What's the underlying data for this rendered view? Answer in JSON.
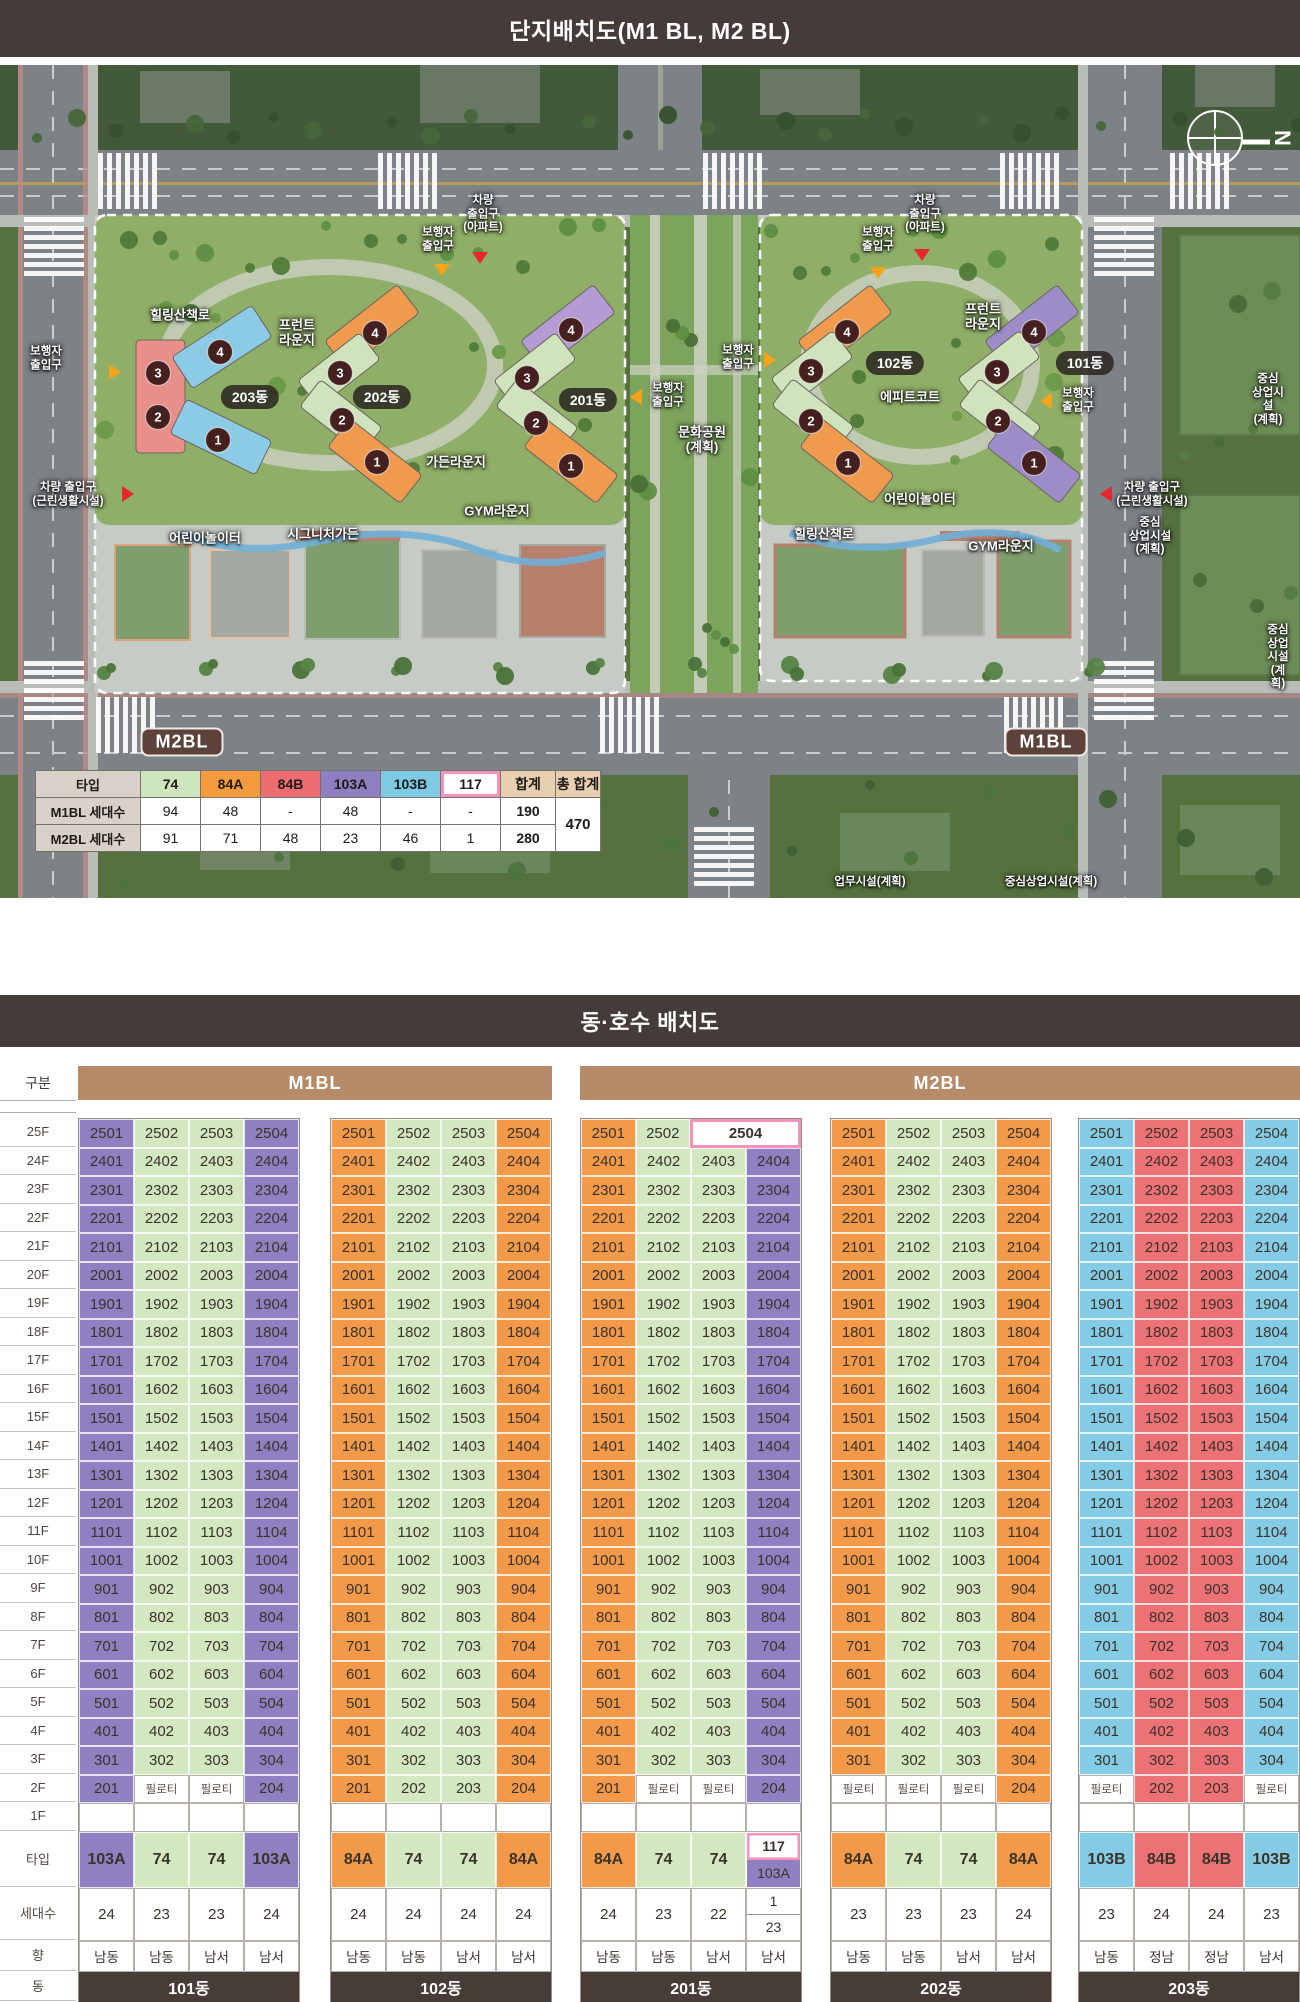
{
  "headers": {
    "site_plan": "단지배치도(M1 BL, M2 BL)",
    "unit_layout": "동·호수 배치도"
  },
  "site_plan": {
    "compass_label": "N",
    "table": {
      "header": [
        "타입",
        "74",
        "84A",
        "84B",
        "103A",
        "103B",
        "117",
        "합계",
        "총 합계"
      ],
      "rows": [
        {
          "label": "M1BL 세대수",
          "values": [
            "94",
            "48",
            "-",
            "48",
            "-",
            "-",
            "190"
          ]
        },
        {
          "label": "M2BL 세대수",
          "values": [
            "91",
            "71",
            "48",
            "23",
            "46",
            "1",
            "280"
          ]
        }
      ],
      "grand_total": "470"
    },
    "labels": [
      {
        "t": "힐링산책로",
        "x": 180,
        "y": 250
      },
      {
        "t": "프런트\n라운지",
        "x": 297,
        "y": 268
      },
      {
        "t": "가든라운지",
        "x": 456,
        "y": 397
      },
      {
        "t": "GYM라운지",
        "x": 497,
        "y": 446
      },
      {
        "t": "어린이놀이터",
        "x": 205,
        "y": 473
      },
      {
        "t": "시그니처가든",
        "x": 323,
        "y": 469
      },
      {
        "t": "문화공원\n(계획)",
        "x": 702,
        "y": 375
      },
      {
        "t": "에피트코트",
        "x": 910,
        "y": 332
      },
      {
        "t": "어린이놀이터",
        "x": 920,
        "y": 434
      },
      {
        "t": "힐링산책로",
        "x": 824,
        "y": 469
      },
      {
        "t": "GYM라운지",
        "x": 1001,
        "y": 481
      },
      {
        "t": "프런트\n라운지",
        "x": 983,
        "y": 252
      },
      {
        "t": "중심\n상업시설\n(계획)",
        "x": 1268,
        "y": 335,
        "small": 1
      },
      {
        "t": "중심\n상업시설\n(계획)",
        "x": 1150,
        "y": 472,
        "small": 1
      },
      {
        "t": "중심\n상업시설\n(계획)",
        "x": 1278,
        "y": 593,
        "small": 1
      },
      {
        "t": "업무시설(계획)",
        "x": 870,
        "y": 818,
        "small": 1
      },
      {
        "t": "중심상업시설(계획)",
        "x": 1051,
        "y": 818,
        "small": 1
      }
    ],
    "building_pills": [
      {
        "t": "203동",
        "x": 250,
        "y": 332
      },
      {
        "t": "202동",
        "x": 382,
        "y": 332
      },
      {
        "t": "201동",
        "x": 588,
        "y": 335
      },
      {
        "t": "102동",
        "x": 895,
        "y": 298
      },
      {
        "t": "101동",
        "x": 1085,
        "y": 298
      }
    ],
    "block_pills": [
      {
        "t": "M2BL",
        "x": 182,
        "y": 677
      },
      {
        "t": "M1BL",
        "x": 1046,
        "y": 677
      }
    ],
    "entrances": [
      {
        "t": "차량\n출입구\n(아파트)",
        "x": 483,
        "y": 150,
        "tri": {
          "x": 480,
          "y": 193,
          "dir": "down",
          "c": "#e8262b"
        }
      },
      {
        "t": "보행자\n출입구",
        "x": 438,
        "y": 175,
        "tri": {
          "x": 442,
          "y": 205,
          "dir": "down",
          "c": "#f5a31a"
        }
      },
      {
        "t": "보행자\n출입구",
        "x": 878,
        "y": 175,
        "tri": {
          "x": 878,
          "y": 208,
          "dir": "down",
          "c": "#f5a31a"
        }
      },
      {
        "t": "차량\n출입구\n(아파트)",
        "x": 925,
        "y": 150,
        "tri": {
          "x": 922,
          "y": 190,
          "dir": "down",
          "c": "#e8262b"
        }
      },
      {
        "t": "보행자\n출입구",
        "x": 46,
        "y": 294,
        "tri": {
          "x": 115,
          "y": 307,
          "dir": "right",
          "c": "#f5a31a"
        }
      },
      {
        "t": "차량 출입구\n(근린생활시설)",
        "x": 68,
        "y": 430,
        "tri": {
          "x": 128,
          "y": 429,
          "dir": "right",
          "c": "#e8262b"
        }
      },
      {
        "t": "보행자\n출입구",
        "x": 668,
        "y": 331,
        "tri": {
          "x": 636,
          "y": 332,
          "dir": "left",
          "c": "#f5a31a"
        }
      },
      {
        "t": "보행자\n출입구",
        "x": 738,
        "y": 293,
        "tri": {
          "x": 770,
          "y": 295,
          "dir": "right",
          "c": "#f5a31a"
        }
      },
      {
        "t": "보행자\n출입구",
        "x": 1078,
        "y": 336,
        "tri": {
          "x": 1046,
          "y": 336,
          "dir": "left",
          "c": "#f5a31a"
        }
      },
      {
        "t": "차량 출입구\n(근린생활시설)",
        "x": 1152,
        "y": 430,
        "tri": {
          "x": 1106,
          "y": 429,
          "dir": "left",
          "c": "#e8262b"
        }
      }
    ],
    "buildings": [
      {
        "name": "203동",
        "wings": [
          {
            "x": 136,
            "y": 275,
            "w": 49,
            "h": 113,
            "rot": 0,
            "f": "#e88f8a"
          },
          {
            "cx": 222,
            "cy": 282,
            "w": 95,
            "h": 38,
            "rot": -33,
            "f": "#8ccbe6"
          },
          {
            "cx": 221,
            "cy": 372,
            "w": 95,
            "h": 38,
            "rot": 26,
            "f": "#8ccbe6"
          }
        ],
        "circles": [
          {
            "n": "4",
            "x": 220,
            "y": 287
          },
          {
            "n": "3",
            "x": 158,
            "y": 308
          },
          {
            "n": "2",
            "x": 158,
            "y": 352
          },
          {
            "n": "1",
            "x": 218,
            "y": 375
          }
        ]
      },
      {
        "name": "202동",
        "wings": [
          {
            "cx": 372,
            "cy": 262,
            "w": 92,
            "h": 36,
            "rot": -38,
            "f": "#f09a4e"
          },
          {
            "cx": 339,
            "cy": 305,
            "w": 78,
            "h": 34,
            "rot": -38,
            "f": "#cfe3bd"
          },
          {
            "cx": 341,
            "cy": 352,
            "w": 78,
            "h": 34,
            "rot": 38,
            "f": "#cfe3bd"
          },
          {
            "cx": 375,
            "cy": 396,
            "w": 92,
            "h": 36,
            "rot": 38,
            "f": "#f09a4e"
          }
        ],
        "circles": [
          {
            "n": "4",
            "x": 375,
            "y": 268
          },
          {
            "n": "3",
            "x": 340,
            "y": 308
          },
          {
            "n": "2",
            "x": 342,
            "y": 355
          },
          {
            "n": "1",
            "x": 377,
            "y": 397
          }
        ]
      },
      {
        "name": "201동",
        "wings": [
          {
            "cx": 568,
            "cy": 262,
            "w": 92,
            "h": 36,
            "rot": -38,
            "f": "#b49bd4"
          },
          {
            "cx": 535,
            "cy": 305,
            "w": 78,
            "h": 34,
            "rot": -38,
            "f": "#cfe3bd"
          },
          {
            "cx": 537,
            "cy": 352,
            "w": 78,
            "h": 34,
            "rot": 38,
            "f": "#cfe3bd"
          },
          {
            "cx": 571,
            "cy": 396,
            "w": 92,
            "h": 36,
            "rot": 38,
            "f": "#f09a4e"
          }
        ],
        "circles": [
          {
            "n": "4",
            "x": 571,
            "y": 265
          },
          {
            "n": "3",
            "x": 527,
            "y": 313
          },
          {
            "n": "2",
            "x": 536,
            "y": 358
          },
          {
            "n": "1",
            "x": 571,
            "y": 401
          }
        ]
      },
      {
        "name": "102동",
        "wings": [
          {
            "cx": 845,
            "cy": 262,
            "w": 92,
            "h": 36,
            "rot": -38,
            "f": "#f09a4e"
          },
          {
            "cx": 812,
            "cy": 303,
            "w": 78,
            "h": 34,
            "rot": -38,
            "f": "#cfe3bd"
          },
          {
            "cx": 813,
            "cy": 351,
            "w": 78,
            "h": 34,
            "rot": 38,
            "f": "#cfe3bd"
          },
          {
            "cx": 847,
            "cy": 396,
            "w": 92,
            "h": 36,
            "rot": 38,
            "f": "#f09a4e"
          }
        ],
        "circles": [
          {
            "n": "4",
            "x": 847,
            "y": 267
          },
          {
            "n": "3",
            "x": 811,
            "y": 306
          },
          {
            "n": "2",
            "x": 811,
            "y": 356
          },
          {
            "n": "1",
            "x": 848,
            "y": 398
          }
        ]
      },
      {
        "name": "101동",
        "wings": [
          {
            "cx": 1032,
            "cy": 262,
            "w": 92,
            "h": 36,
            "rot": -38,
            "f": "#9c8cc8"
          },
          {
            "cx": 999,
            "cy": 303,
            "w": 78,
            "h": 34,
            "rot": -38,
            "f": "#cfe3bd"
          },
          {
            "cx": 1000,
            "cy": 351,
            "w": 78,
            "h": 34,
            "rot": 38,
            "f": "#cfe3bd"
          },
          {
            "cx": 1034,
            "cy": 396,
            "w": 92,
            "h": 36,
            "rot": 38,
            "f": "#9c8cc8"
          }
        ],
        "circles": [
          {
            "n": "4",
            "x": 1034,
            "y": 267
          },
          {
            "n": "3",
            "x": 997,
            "y": 307
          },
          {
            "n": "2",
            "x": 998,
            "y": 356
          },
          {
            "n": "1",
            "x": 1034,
            "y": 398
          }
        ]
      }
    ]
  },
  "grid": {
    "col_header": "구분",
    "row_labels": {
      "type": "타입",
      "count": "세대수",
      "direction": "향",
      "building": "동"
    },
    "floors": [
      "25F",
      "24F",
      "23F",
      "22F",
      "21F",
      "20F",
      "19F",
      "18F",
      "17F",
      "16F",
      "15F",
      "14F",
      "13F",
      "12F",
      "11F",
      "10F",
      "9F",
      "8F",
      "7F",
      "6F",
      "5F",
      "4F",
      "3F",
      "2F",
      "1F"
    ],
    "pilotis_label": "필로티",
    "groups": [
      {
        "label": "M1BL",
        "from": 0,
        "to": 1
      },
      {
        "label": "M2BL",
        "from": 2,
        "to": 4
      }
    ],
    "type_colors": {
      "74": "#d3e7c0",
      "84A": "#f2994a",
      "84B": "#ec7276",
      "103A": "#8f81c1",
      "103B": "#84cbe5",
      "117": "#ffffff"
    },
    "buildings": [
      {
        "name": "101동",
        "cols": [
          "103A",
          "74",
          "74",
          "103A"
        ],
        "floor2": [
          {
            "u": "201",
            "t": "103A"
          },
          {
            "p": 1
          },
          {
            "p": 1
          },
          {
            "u": "204",
            "t": "103A"
          }
        ],
        "type_cells": [
          {
            "t": "103A"
          },
          {
            "t": "74"
          },
          {
            "t": "74"
          },
          {
            "t": "103A"
          }
        ],
        "counts": [
          "24",
          "23",
          "23",
          "24"
        ],
        "dirs": [
          "남동",
          "남동",
          "남서",
          "남서"
        ]
      },
      {
        "name": "102동",
        "cols": [
          "84A",
          "74",
          "74",
          "84A"
        ],
        "floor2": [
          {
            "u": "201",
            "t": "84A"
          },
          {
            "u": "202",
            "t": "74"
          },
          {
            "u": "203",
            "t": "74"
          },
          {
            "u": "204",
            "t": "84A"
          }
        ],
        "type_cells": [
          {
            "t": "84A"
          },
          {
            "t": "74"
          },
          {
            "t": "74"
          },
          {
            "t": "84A"
          }
        ],
        "counts": [
          "24",
          "24",
          "24",
          "24"
        ],
        "dirs": [
          "남동",
          "남동",
          "남서",
          "남서"
        ]
      },
      {
        "name": "201동",
        "cols": [
          "84A",
          "74",
          "74",
          "103A"
        ],
        "floor25": [
          {
            "u": "2501",
            "t": "84A"
          },
          {
            "u": "2502",
            "t": "74"
          },
          {
            "u": "2504",
            "t": "117",
            "span": 2
          }
        ],
        "floor2": [
          {
            "u": "201",
            "t": "84A"
          },
          {
            "p": 1
          },
          {
            "p": 1
          },
          {
            "u": "204",
            "t": "103A"
          }
        ],
        "type_cells": [
          {
            "t": "84A"
          },
          {
            "t": "74"
          },
          {
            "t": "74"
          },
          {
            "split_types": [
              "117",
              "103A"
            ]
          }
        ],
        "counts": [
          "24",
          "23",
          "22",
          {
            "split": [
              "1",
              "23"
            ]
          }
        ],
        "dirs": [
          "남동",
          "남동",
          "남서",
          "남서"
        ]
      },
      {
        "name": "202동",
        "cols": [
          "84A",
          "74",
          "74",
          "84A"
        ],
        "floor2": [
          {
            "p": 1
          },
          {
            "p": 1
          },
          {
            "p": 1
          },
          {
            "u": "204",
            "t": "84A"
          }
        ],
        "type_cells": [
          {
            "t": "84A"
          },
          {
            "t": "74"
          },
          {
            "t": "74"
          },
          {
            "t": "84A"
          }
        ],
        "counts": [
          "23",
          "23",
          "23",
          "24"
        ],
        "dirs": [
          "남동",
          "남동",
          "남서",
          "남서"
        ]
      },
      {
        "name": "203동",
        "cols": [
          "103B",
          "84B",
          "84B",
          "103B"
        ],
        "floor2": [
          {
            "p": 1
          },
          {
            "u": "202",
            "t": "84B"
          },
          {
            "u": "203",
            "t": "84B"
          },
          {
            "p": 1
          }
        ],
        "type_cells": [
          {
            "t": "103B"
          },
          {
            "t": "84B"
          },
          {
            "t": "84B"
          },
          {
            "t": "103B"
          }
        ],
        "counts": [
          "23",
          "24",
          "24",
          "23"
        ],
        "dirs": [
          "남동",
          "정남",
          "정남",
          "남서"
        ]
      }
    ]
  }
}
